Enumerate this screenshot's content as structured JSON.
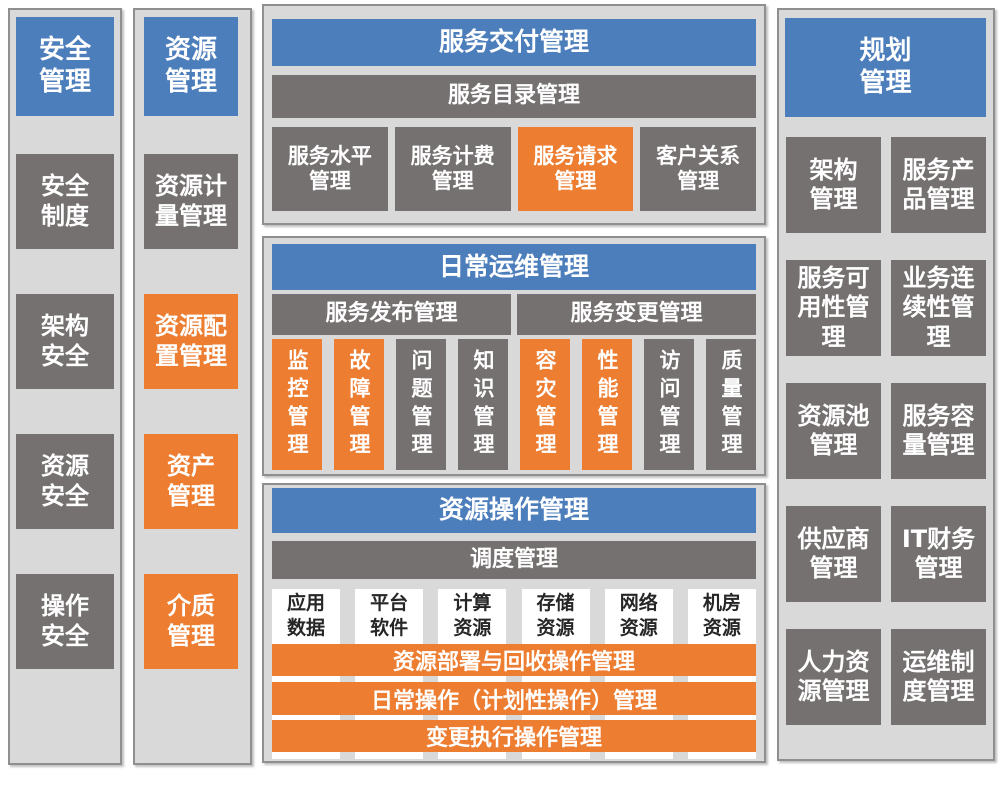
{
  "colors": {
    "header_blue": "#4d7ebc",
    "box_gray": "#767171",
    "accent_orange": "#ed7d31",
    "panel_background": "#d9d9d9",
    "panel_border": "#8f8f8f"
  },
  "security": {
    "title": "安全\n管理",
    "items": [
      {
        "label": "安全\n制度",
        "style": "gray"
      },
      {
        "label": "架构\n安全",
        "style": "gray"
      },
      {
        "label": "资源\n安全",
        "style": "gray"
      },
      {
        "label": "操作\n安全",
        "style": "gray"
      }
    ]
  },
  "resource": {
    "title": "资源\n管理",
    "items": [
      {
        "label": "资源计\n量管理",
        "style": "gray"
      },
      {
        "label": "资源配\n置管理",
        "style": "orange"
      },
      {
        "label": "资产\n管理",
        "style": "orange"
      },
      {
        "label": "介质\n管理",
        "style": "orange"
      }
    ]
  },
  "service_delivery": {
    "title": "服务交付管理",
    "catalog_bar": "服务目录管理",
    "items": [
      {
        "label": "服务水平\n管理",
        "style": "gray"
      },
      {
        "label": "服务计费\n管理",
        "style": "gray"
      },
      {
        "label": "服务请求\n管理",
        "style": "orange"
      },
      {
        "label": "客户关系\n管理",
        "style": "gray"
      }
    ]
  },
  "daily_ops": {
    "title": "日常运维管理",
    "bars": [
      {
        "label": "服务发布管理"
      },
      {
        "label": "服务变更管理"
      }
    ],
    "items": [
      {
        "label": "监控管理",
        "style": "orange"
      },
      {
        "label": "故障管理",
        "style": "orange"
      },
      {
        "label": "问题管理",
        "style": "gray"
      },
      {
        "label": "知识管理",
        "style": "gray"
      },
      {
        "label": "容灾管理",
        "style": "orange"
      },
      {
        "label": "性能管理",
        "style": "orange"
      },
      {
        "label": "访问管理",
        "style": "gray"
      },
      {
        "label": "质量管理",
        "style": "gray"
      }
    ]
  },
  "resource_ops": {
    "title": "资源操作管理",
    "dispatch_bar": "调度管理",
    "columns": [
      {
        "label": "应用\n数据"
      },
      {
        "label": "平台\n软件"
      },
      {
        "label": "计算\n资源"
      },
      {
        "label": "存储\n资源"
      },
      {
        "label": "网络\n资源"
      },
      {
        "label": "机房\n资源"
      }
    ],
    "bars": [
      {
        "label": "资源部署与回收操作管理"
      },
      {
        "label": "日常操作（计划性操作）管理"
      },
      {
        "label": "变更执行操作管理"
      }
    ]
  },
  "planning": {
    "title": "规划\n管理",
    "items": [
      {
        "label": "架构\n管理"
      },
      {
        "label": "服务产\n品管理"
      },
      {
        "label": "服务可\n用性管\n理"
      },
      {
        "label": "业务连\n续性管\n理"
      },
      {
        "label": "资源池\n管理"
      },
      {
        "label": "服务容\n量管理"
      },
      {
        "label": "供应商\n管理"
      },
      {
        "label": "IT财务\n管理"
      },
      {
        "label": "人力资\n源管理"
      },
      {
        "label": "运维制\n度管理"
      }
    ]
  }
}
